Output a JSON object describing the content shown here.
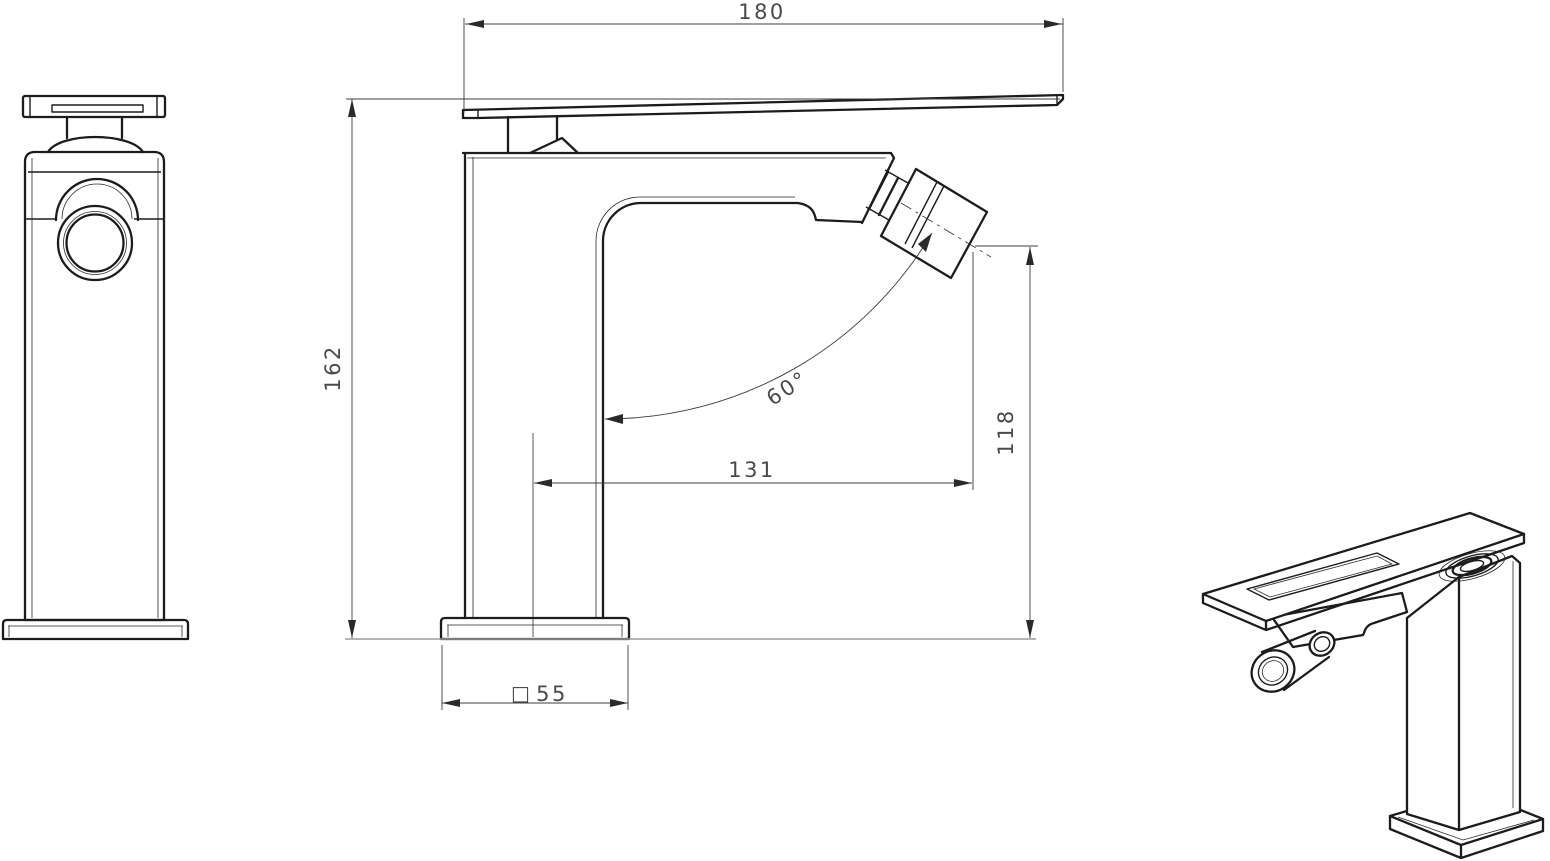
{
  "drawing": {
    "dims": {
      "overall_width": "180",
      "overall_height": "162",
      "spout_reach": "131",
      "outlet_height": "118",
      "aerator_angle": "60°",
      "base_size": "55",
      "square_symbol": "□"
    },
    "colors": {
      "object_line": "#1c1c1c",
      "dimension_line": "#3c3c3c",
      "text": "#4a4a4a",
      "ground_line": "#9c9c9c",
      "background": "#ffffff"
    }
  }
}
